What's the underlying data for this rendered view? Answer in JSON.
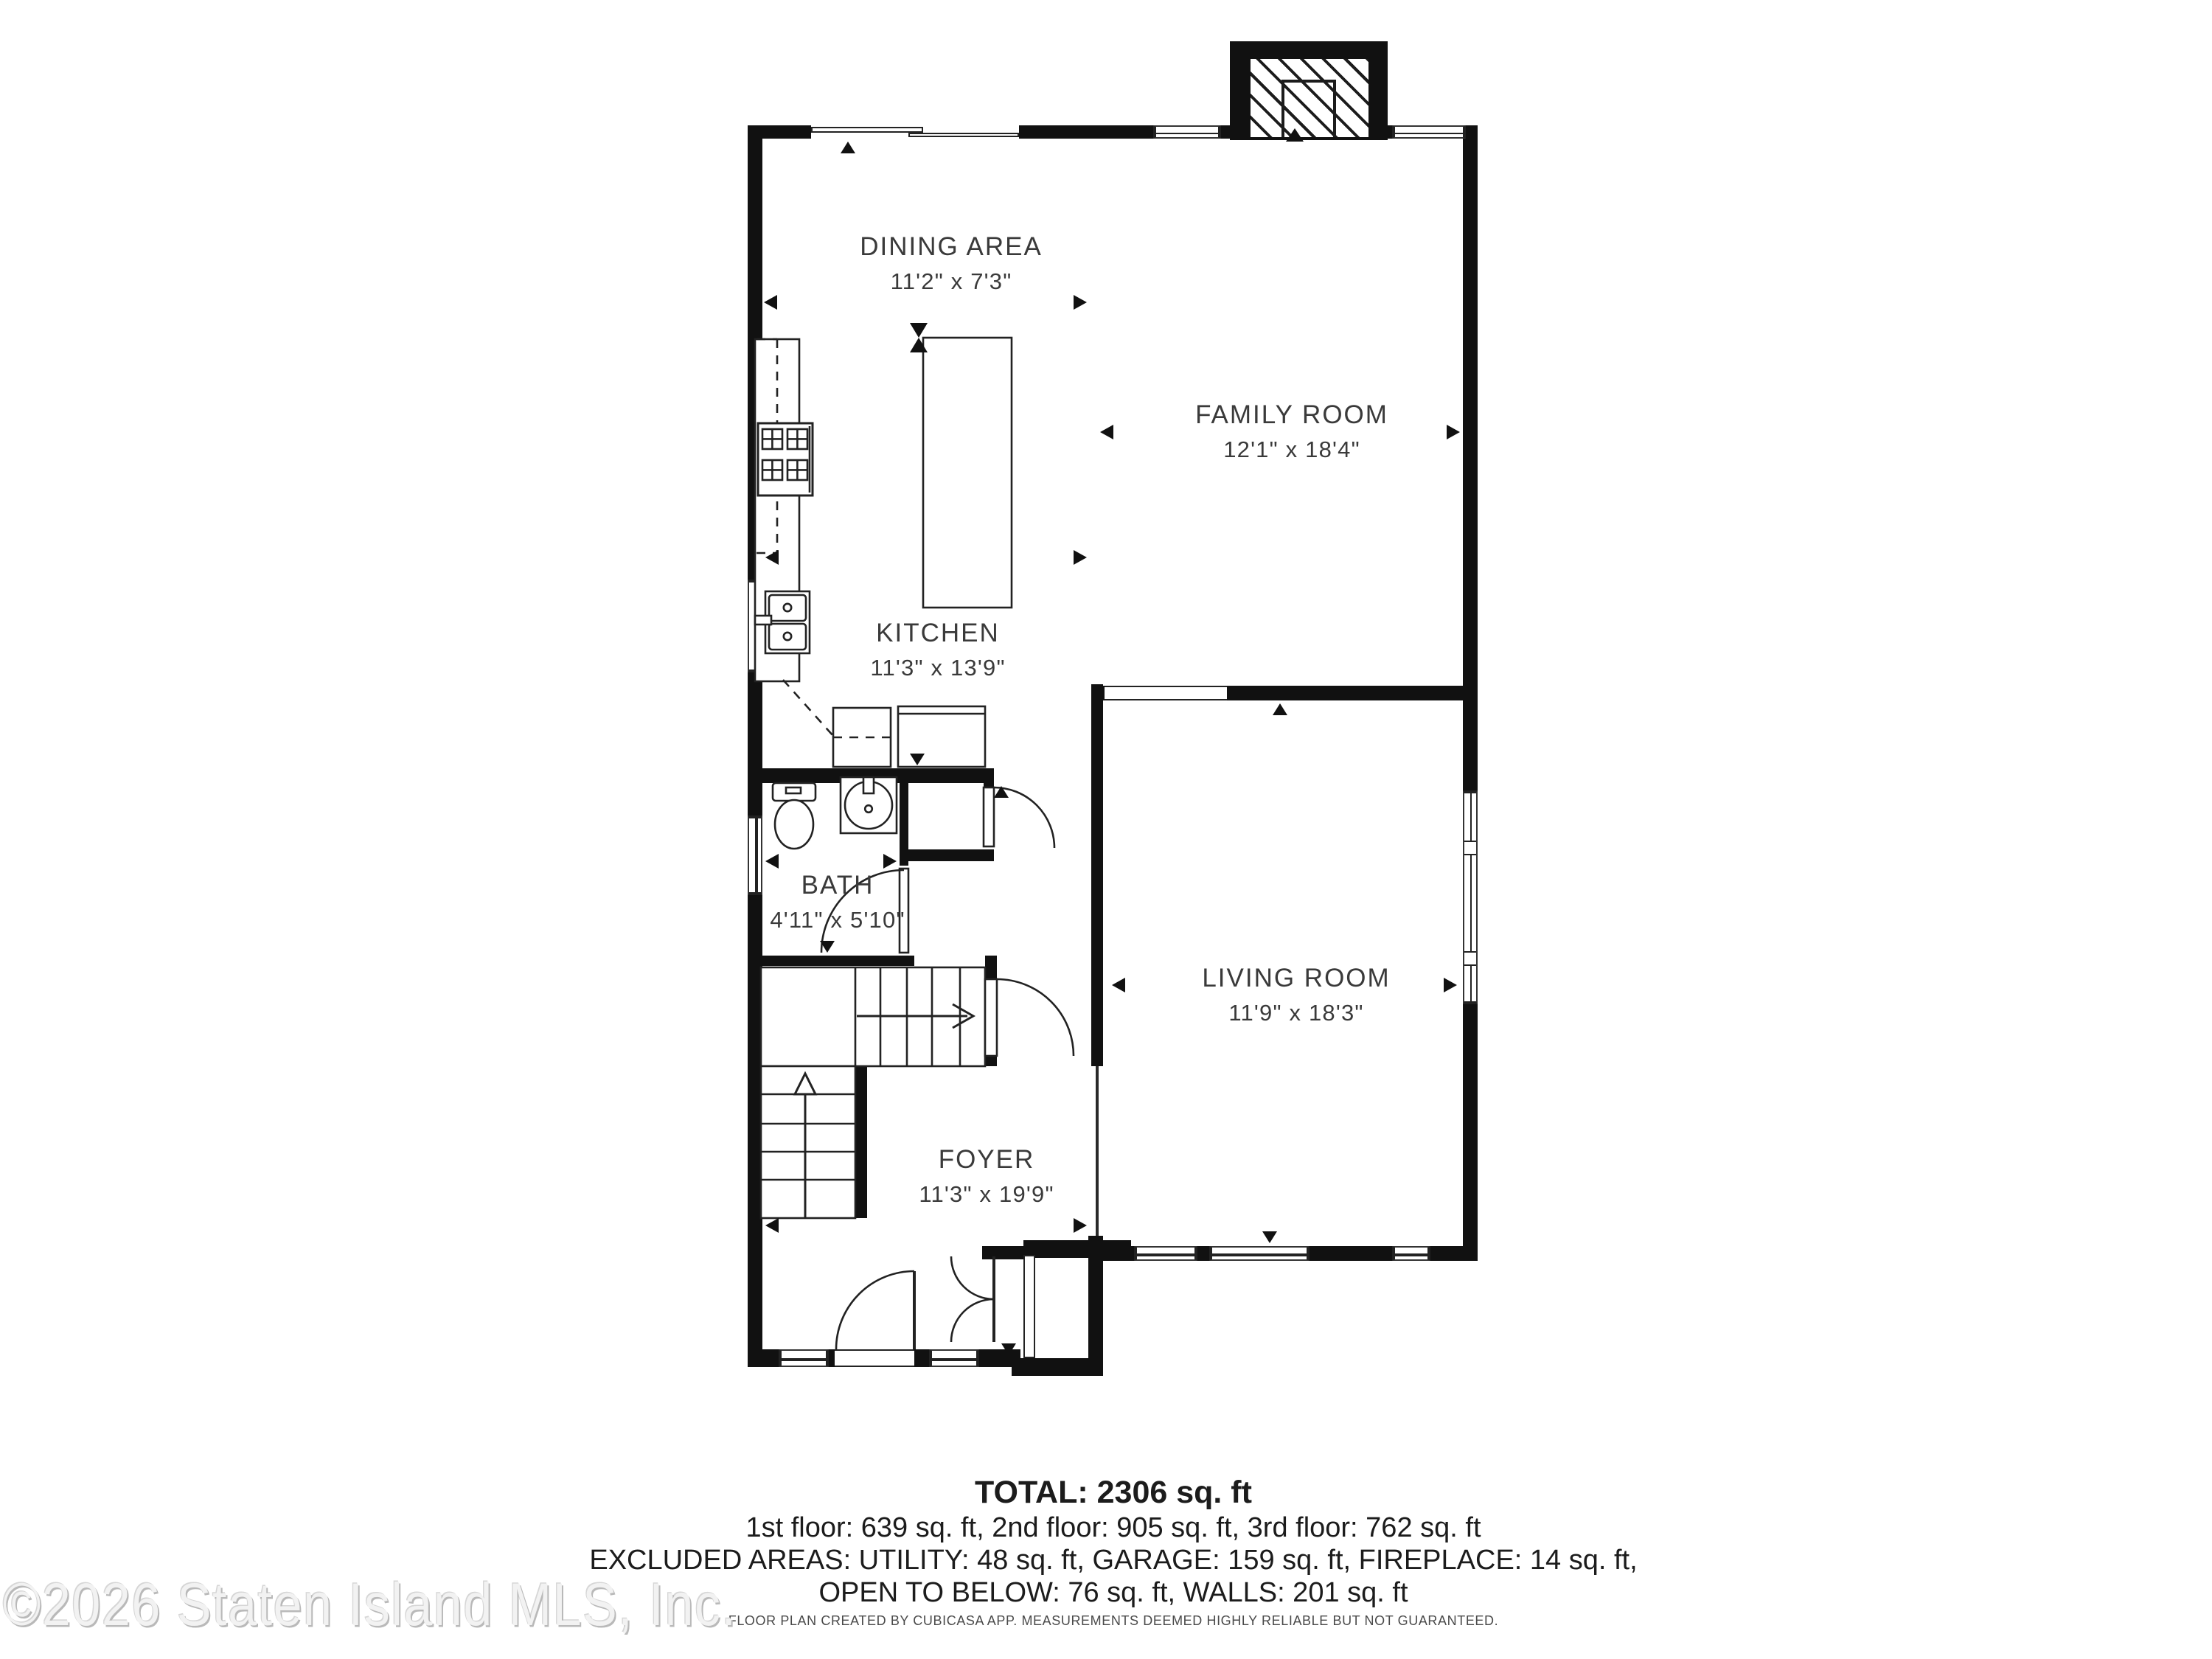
{
  "rooms": [
    {
      "name": "DINING AREA",
      "dims": "11'2\" x 7'3\""
    },
    {
      "name": "FAMILY ROOM",
      "dims": "12'1\" x 18'4\""
    },
    {
      "name": "KITCHEN",
      "dims": "11'3\" x 13'9\""
    },
    {
      "name": "BATH",
      "dims": "4'11\" x 5'10\""
    },
    {
      "name": "LIVING ROOM",
      "dims": "11'9\" x 18'3\""
    },
    {
      "name": "FOYER",
      "dims": "11'3\" x 19'9\""
    }
  ],
  "footer": {
    "total": "TOTAL: 2306 sq. ft",
    "floors": "1st floor: 639 sq. ft, 2nd floor: 905 sq. ft, 3rd floor: 762 sq. ft",
    "excluded": "EXCLUDED AREAS: UTILITY: 48 sq. ft, GARAGE: 159 sq. ft, FIREPLACE: 14 sq. ft,",
    "open_below": "OPEN TO BELOW: 76 sq. ft, WALLS: 201 sq. ft",
    "disclaimer": "FLOOR PLAN CREATED BY CUBICASA APP. MEASUREMENTS DEEMED HIGHLY RELIABLE BUT NOT GUARANTEED."
  },
  "watermark": "©2026 Staten Island MLS, Inc.",
  "colors": {
    "wall": "#111111",
    "label": "#3a3a3a",
    "watermark_gray": "#c0c0c0"
  }
}
